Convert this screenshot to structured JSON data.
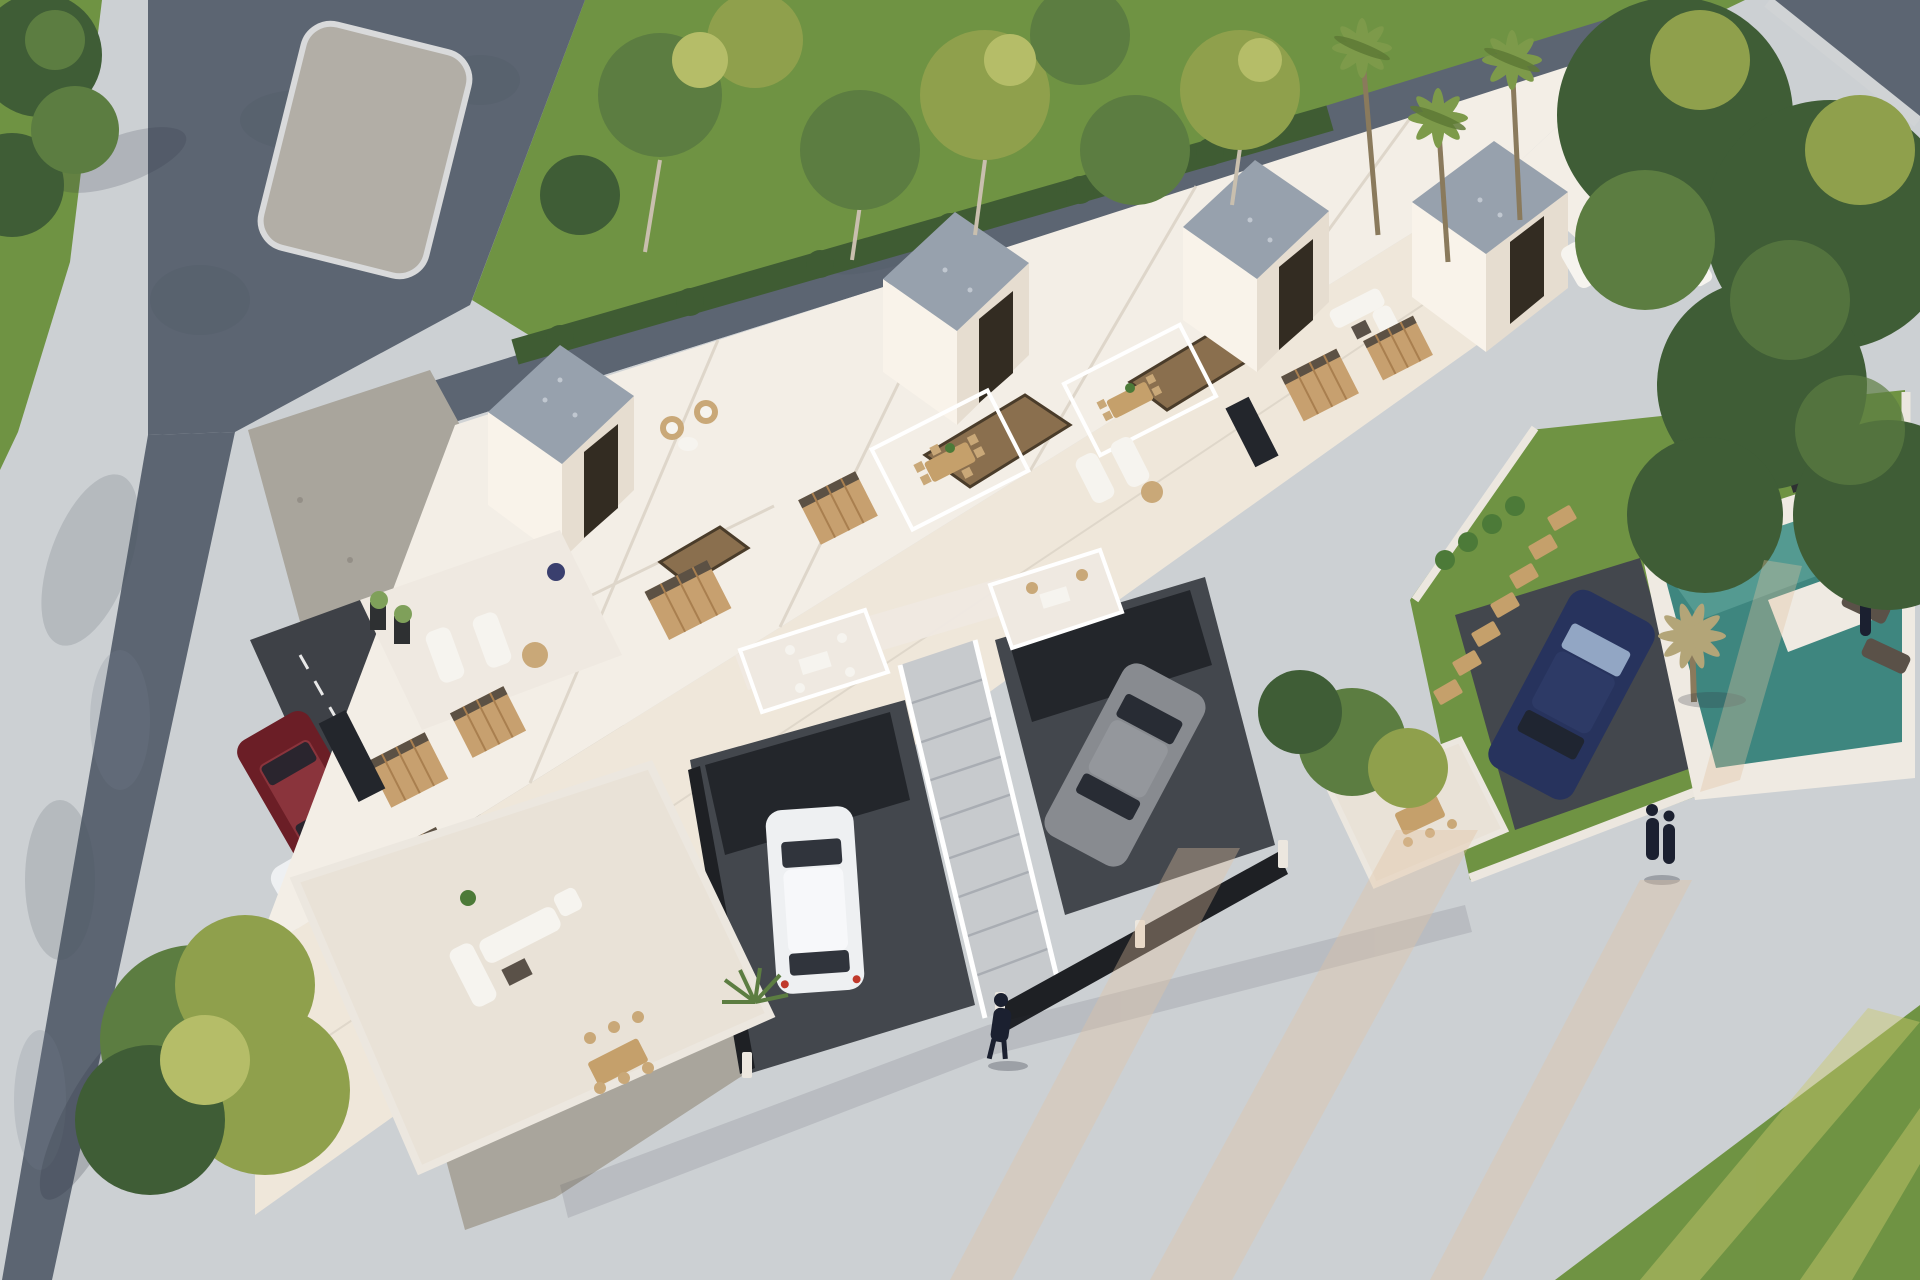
{
  "scene": {
    "type": "3d-architectural-render",
    "view": "aerial",
    "subject": "white modern residential complex with roof terraces, driveways, street parking and private pool garden",
    "lighting": "low warm sun with long light streaks"
  },
  "inventory": {
    "stair_towers": 4,
    "people": 4,
    "pools": 1,
    "cars": [
      {
        "label": "maroon-suv-street"
      },
      {
        "label": "white-suv-street"
      },
      {
        "label": "white-hatchback-driveway"
      },
      {
        "label": "gray-sedan-driveway"
      },
      {
        "label": "navy-car-driveway"
      }
    ],
    "vegetation": [
      "lawn",
      "hedge",
      "deciduous-trees",
      "palm-trees",
      "dry-garden-palm",
      "agave-planters"
    ]
  },
  "colors": {
    "base_pavement": "#ccd0d3",
    "road": "#5c6572",
    "road_mottle": "#4d5664",
    "road_worn": "#788292",
    "median": "#b2aea6",
    "median_edge": "#d9dadb",
    "sidewalk": "#d0d3d5",
    "lawn": "#6f9343",
    "lawn_dark": "#567a34",
    "grass_streak": "#c9c96e",
    "hedge": "#3f5c33",
    "tree_dark": "#3f5d36",
    "tree_mid": "#5c7d41",
    "tree_light": "#8fa04c",
    "tree_yellow": "#b5bd68",
    "trunk": "#c9bfae",
    "palm_frond": "#7d9a4a",
    "palm_frond_dark": "#5e7a36",
    "palm_dry": "#b3a578",
    "palm_trunk": "#8a7a5c",
    "building_white": "#f3eee6",
    "building_warm": "#efe7da",
    "building_lit": "#f9f3ea",
    "building_shade": "#e6ddd0",
    "parapet": "#ffffff",
    "parapet_shadow": "#d9d1c4",
    "gravel_roof": "#97a1ad",
    "gravel_fleck": "#c5ccd4",
    "gravel_strip": "#a9a59c",
    "gravel_dot": "#8e8a82",
    "asphalt": "#43474d",
    "asphalt_dark": "#23262b",
    "lane_asphalt": "#3e4147",
    "dash_white": "#e8e8e8",
    "stair": "#c7cacd",
    "stair_line": "#a9adb3",
    "opening_floor": "#8a6f4e",
    "opening_dark": "#4a3c2a",
    "door_dark": "#332c22",
    "shutter": "#c7a06f",
    "shutter_slat": "#a97f4f",
    "window_dark": "#23262c",
    "furn_white": "#f6f4ef",
    "furn_wood": "#c5a06b",
    "wicker": "#c9a878",
    "table_dark": "#5a5148",
    "terrace_floor": "#e9e2d7",
    "balcony_floor": "#efe9e1",
    "pool_deck": "#efeae2",
    "pool_water": "#3e867f",
    "pool_water_light": "#7fc0b4",
    "planter_dark": "#2e3032",
    "plant_green": "#4c7a38",
    "flower_red": "#b23b2e",
    "agave": "#7fa05a",
    "car_red": "#6b1e26",
    "car_red_hi": "#8a343c",
    "car_white": "#eef0f2",
    "car_white_hi": "#f7f8fa",
    "car_gray": "#888b90",
    "car_gray_hi": "#94979c",
    "car_blue": "#27335d",
    "car_blue_hi": "#2d3a66",
    "glass_dark": "#1f242c",
    "glass_blue": "#9fb3cf",
    "taillight": "#c0392b",
    "fence_dark": "#1e2024",
    "wall_white": "#ece7df",
    "person": "#1b2030",
    "shadow": "#2f3340",
    "sun_streak": "#e3c2a0",
    "pot_blue": "#3a3f6e"
  }
}
